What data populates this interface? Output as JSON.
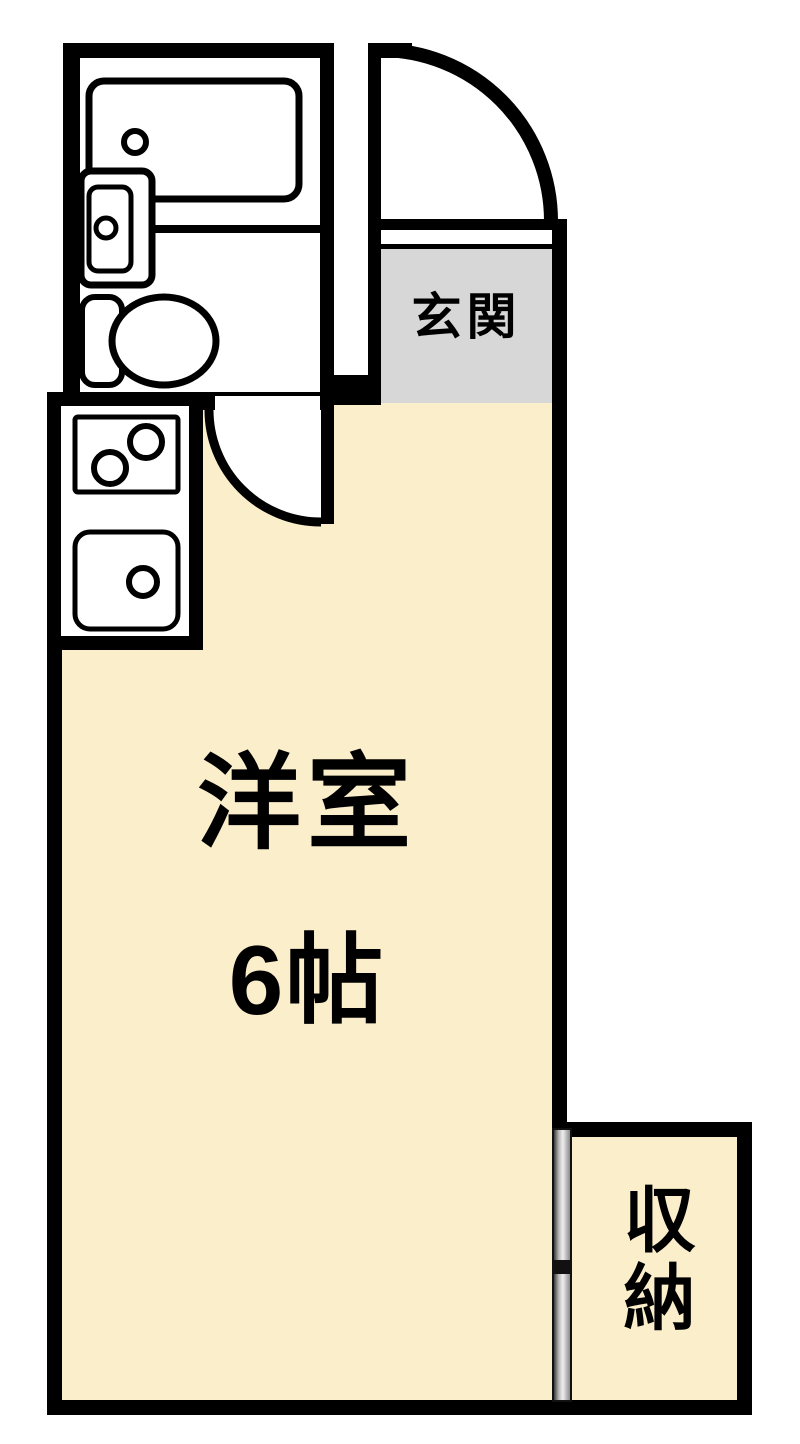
{
  "plan": {
    "rooms": {
      "entrance": {
        "label": "玄関"
      },
      "main": {
        "label": "洋室",
        "size": "6帖"
      },
      "storage": {
        "label": "収納"
      }
    },
    "colors": {
      "wall": "#000000",
      "floor_cream": "#FBEECA",
      "entry_gray": "#D7D7D7",
      "fixture_white": "#FFFFFF"
    }
  }
}
